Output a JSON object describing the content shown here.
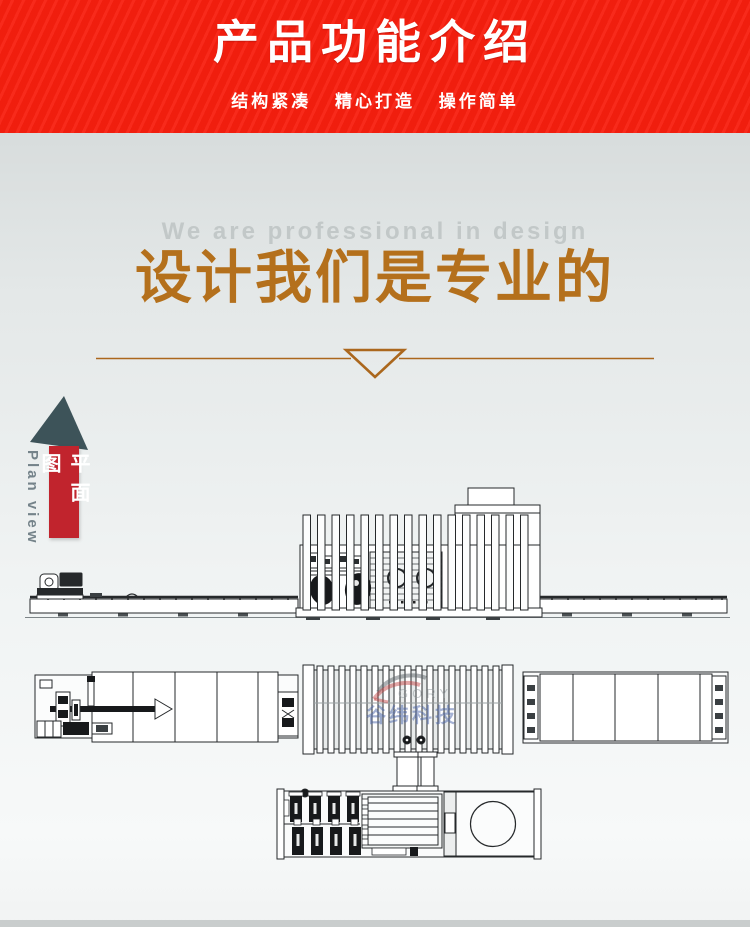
{
  "banner": {
    "title": "产品功能介绍",
    "subtitle": "结构紧凑 精心打造 操作简单",
    "bg_color": "#f81f0f"
  },
  "hero": {
    "subtitle_en": "We are professional in design",
    "title_zh": "设计我们是专业的",
    "accent_color": "#b4701c"
  },
  "side_label": {
    "zh": "平面图",
    "en": "Plan view",
    "bar_color": "#c1242d",
    "arrow_color": "#3d5359"
  },
  "drawings": {
    "watermark_zh": "谷纬科技",
    "watermark_latin": "GORY",
    "watermark_blue": "#4a63a8",
    "line_color": "#26292b"
  }
}
